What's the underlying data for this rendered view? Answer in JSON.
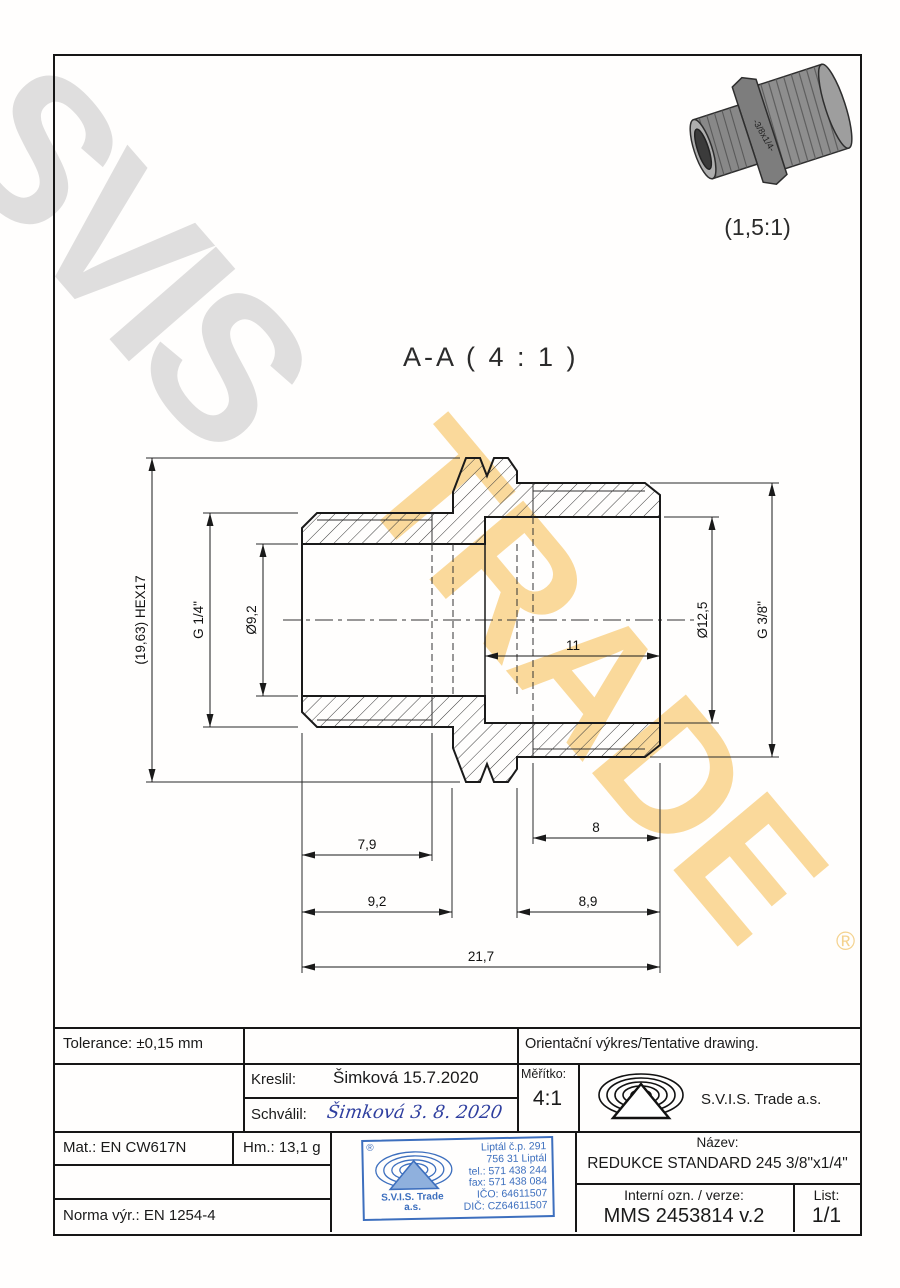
{
  "watermark": {
    "word_top": "SVIS",
    "word_bottom": "TRADE",
    "registered": "®"
  },
  "photo": {
    "scale_label": "(1,5:1)",
    "marking": "-3/8x1/4-"
  },
  "section": {
    "title": "A-A ( 4 : 1 )",
    "dims": {
      "hex": "(19,63) HEX17",
      "thread_left": "G 1/4\"",
      "bore_left": "Ø9,2",
      "bore_right": "Ø12,5",
      "thread_right": "G 3/8\"",
      "depth_right": "11",
      "thread_len_left": "7,9",
      "thread_len_right": "8",
      "seg_left": "9,2",
      "seg_right": "8,9",
      "total_len": "21,7"
    }
  },
  "titleblock": {
    "tolerance": "Tolerance: ±0,15 mm",
    "orientacni": "Orientační výkres/Tentative drawing.",
    "kreslil_label": "Kreslil:",
    "kreslil_value": "Šimková 15.7.2020",
    "schvalil_label": "Schválil:",
    "schvalil_value": "Šimková 3. 8. 2020",
    "meritko_label": "Měřítko:",
    "meritko_value": "4:1",
    "company": "S.V.I.S. Trade a.s.",
    "mat": "Mat.: EN CW617N",
    "hm": "Hm.: 13,1 g",
    "norma": "Norma výr.: EN 1254-4",
    "nazev_label": "Název:",
    "nazev_value": "REDUKCE STANDARD 245 3/8\"x1/4\"",
    "interni_label": "Interní ozn. / verze:",
    "interni_value": "MMS 2453814 v.2",
    "list_label": "List:",
    "list_value": "1/1"
  },
  "stamp": {
    "registered": "®",
    "line1": "Liptál č.p. 291",
    "line2": "756 31 Liptál",
    "line3": "tel.: 571 438 244",
    "line4": "fax: 571 438 084",
    "line5": "IČO: 64611507",
    "line6": "DIČ: CZ64611507",
    "name": "S.V.I.S. Trade",
    "suffix": "a.s."
  },
  "colors": {
    "ink": "#1a1a1a",
    "stamp_blue": "#3d6fbe",
    "signature_blue": "#2f3f9f",
    "watermark_gray": "#aaaaaa",
    "watermark_yellow": "#f6ba4a"
  }
}
